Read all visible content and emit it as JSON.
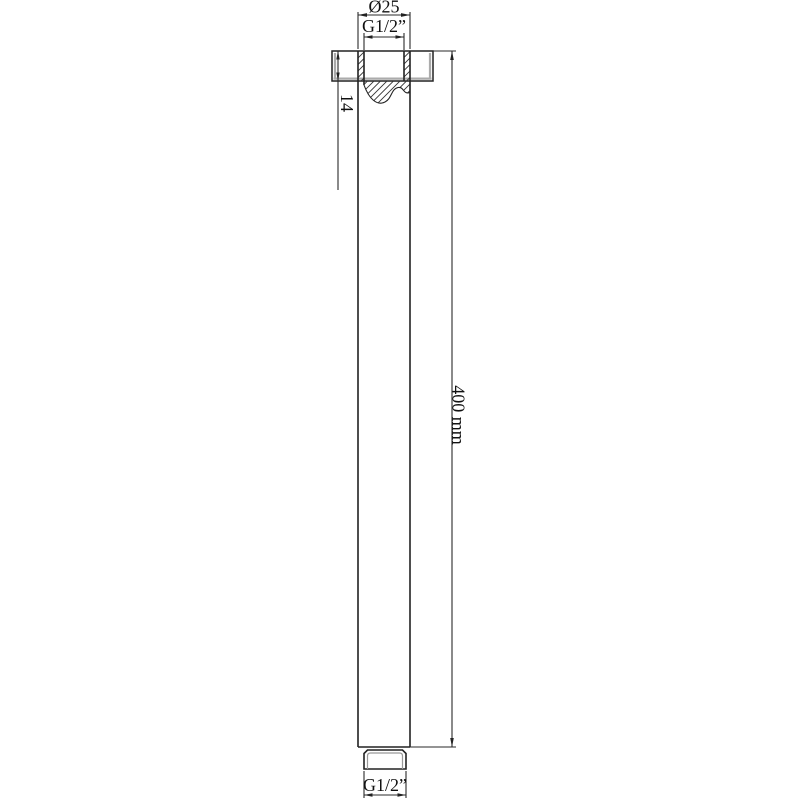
{
  "page": {
    "background": "#ffffff"
  },
  "drawing": {
    "kind": "technical-dimension-drawing",
    "labels": {
      "top_diameter": "Ø25",
      "top_thread": "G1/2”",
      "neck_height": "14",
      "arm_length": "400 mm",
      "bottom_thread": "G1/2”"
    },
    "colors": {
      "line": "#222222",
      "dim_line": "#2a2a2a",
      "shadow_gray": "#ababab",
      "text": "#111111",
      "background": "#ffffff"
    }
  }
}
